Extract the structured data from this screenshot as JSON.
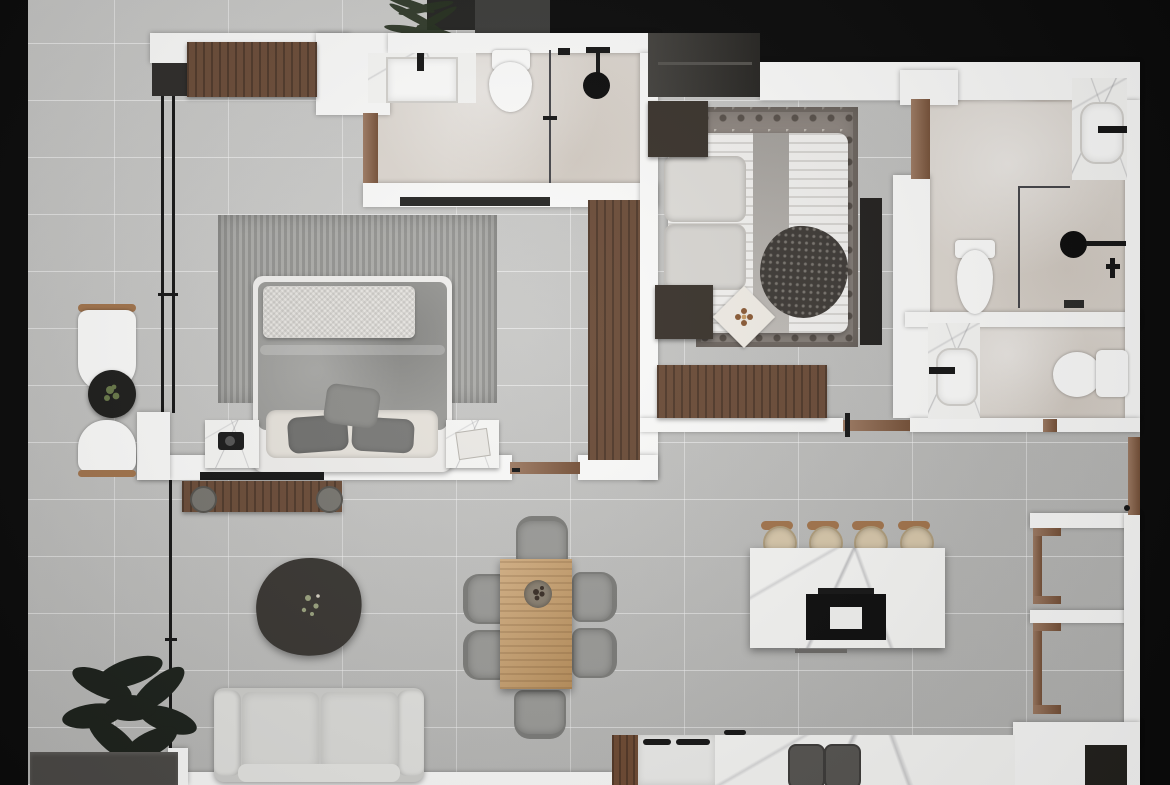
{
  "app": {
    "label": "top-down 3d rendered apartment floor plan, no visible text",
    "view": "top-down-render"
  },
  "palette": {
    "exterior_void": "#0b0b0b",
    "wall_white": "#fbfbfa",
    "floor_tile_gray": "#c9c9c7",
    "bathroom_floor_beige": "#ddd7d0",
    "marble_white": "#f7f7f5",
    "wood_dark": "#5d4332",
    "wood_mid": "#8a5f42",
    "wood_light": "#c89b63",
    "fabric_gray": "#9a9a97",
    "sofa_light_gray": "#dadad7",
    "accent_black": "#161616",
    "plant_green": "#202a1e"
  },
  "rooms": [
    {
      "id": "balcony-left",
      "furniture": [
        "lounge-chair",
        "round-side-table",
        "potted-plant",
        "lounge-chair",
        "floor-plant",
        "bench"
      ]
    },
    {
      "id": "master-bedroom",
      "furniture": [
        "wardrobe",
        "ribbed-area-rug",
        "double-bed",
        "knit-throw",
        "pillows",
        "marble-nightstand",
        "marble-nightstand",
        "window-wall"
      ]
    },
    {
      "id": "bathroom-top",
      "furniture": [
        "marble-vanity-sink",
        "toilet",
        "glass-shower",
        "rain-shower-head",
        "bath-mat"
      ]
    },
    {
      "id": "bedroom-2",
      "furniture": [
        "wardrobe",
        "patterned-rug",
        "double-bed",
        "nightstand",
        "nightstand",
        "wood-dresser",
        "tv-panel",
        "wood-door"
      ]
    },
    {
      "id": "ensuite-bathroom",
      "furniture": [
        "marble-vanity-sink",
        "toilet",
        "glass-shower",
        "rain-shower-head",
        "floor-drain"
      ]
    },
    {
      "id": "guest-bathroom",
      "furniture": [
        "marble-vanity-sink",
        "toilet"
      ]
    },
    {
      "id": "living-dining",
      "furniture": [
        "tv-wall",
        "tv-console",
        "organic-coffee-table",
        "sofa",
        "dining-table",
        "dining-chair-x6",
        "decor-bowl"
      ]
    },
    {
      "id": "kitchen",
      "furniture": [
        "marble-island",
        "cooktop",
        "bar-stool-x4",
        "marble-counter",
        "double-sink",
        "refrigerator"
      ]
    },
    {
      "id": "entry-hall",
      "furniture": [
        "entry-door",
        "door-threshold",
        "storage-niche",
        "storage-niche",
        "doormat"
      ]
    }
  ]
}
